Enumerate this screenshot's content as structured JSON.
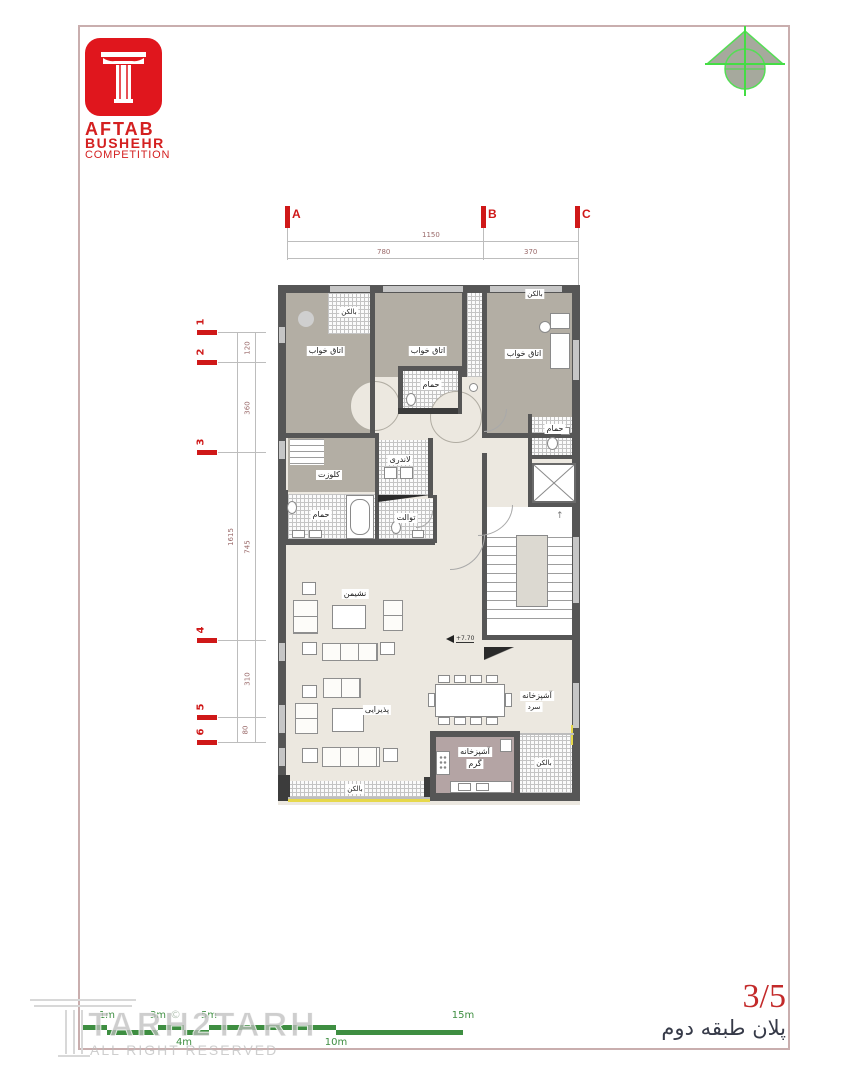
{
  "logo": {
    "title": "AFTAB",
    "subtitle": "BUSHEHR",
    "subtitle2": "COMPETITION"
  },
  "grid": {
    "col_labels": [
      "A",
      "B",
      "C"
    ],
    "row_labels": [
      "1",
      "2",
      "3",
      "4",
      "5",
      "6"
    ]
  },
  "dims": {
    "top_total": "1150",
    "top_seg_ab": "780",
    "top_seg_bc": "370",
    "left_total": "1615",
    "left_segs": [
      "120",
      "360",
      "745",
      "310",
      "80"
    ]
  },
  "rooms": {
    "bedroom1": "اتاق خواب",
    "bedroom2": "اتاق خواب",
    "bedroom3": "اتاق خواب",
    "balcony_tl": "بالکن",
    "balcony_tr": "بالکن",
    "balcony_br": "بالکن",
    "balcony_bottom": "بالکن",
    "bath_mid": "حمام",
    "bath_right": "حمام",
    "bath_master": "حمام",
    "closet": "کلوزت",
    "laundry": "لاندری",
    "toilet": "توالت",
    "living": "نشیمن",
    "reception": "پذیرایی",
    "kitchen_cold_line1": "آشپزخانه",
    "kitchen_cold_line2": "سرد",
    "kitchen_warm_line1": "آشپزخانه",
    "kitchen_warm_line2": "گرم"
  },
  "level_marker": "+7.70",
  "stairs": {
    "up_arrow": "↑"
  },
  "scalebar": {
    "top_labels": [
      "1m",
      "3m",
      "5m",
      "15m"
    ],
    "bottom_labels": [
      "4m",
      "10m"
    ]
  },
  "watermark": {
    "brand": "TARH2TARH",
    "rights": "ALL RIGHT RESERVED",
    "copyright": "©"
  },
  "titleblock": {
    "sheet_no": "3/5",
    "title": "پلان طبقه دوم"
  },
  "colors": {
    "logo_red": "#e0161d",
    "marker_red": "#cf1818",
    "scale_green": "#3e8e41",
    "compass_green": "#55dd55",
    "wall_gray": "#565656",
    "floor_taupe": "#b3aea4",
    "floor_cream": "#ece8e0",
    "kitchen_mauve": "#b4a4a4",
    "accent_yellow": "#e6d84a",
    "frame_pink": "#c9aeae"
  }
}
